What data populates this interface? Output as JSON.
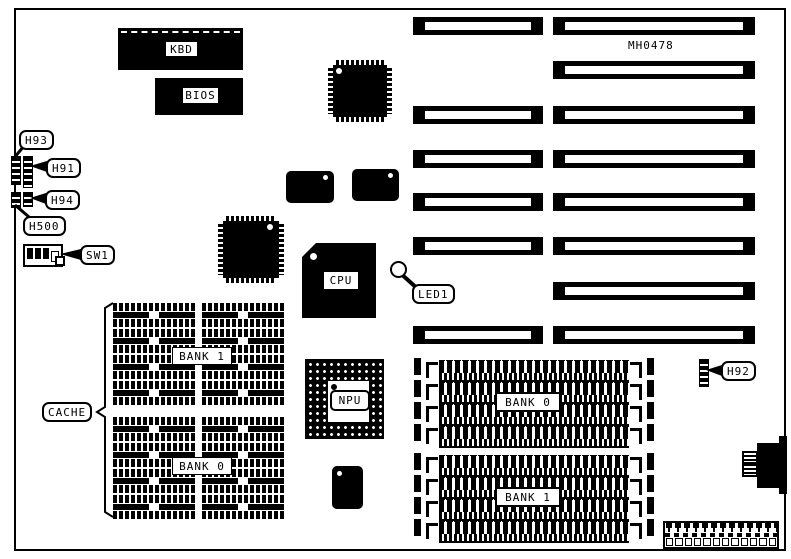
{
  "diagram": {
    "part_number": "MH0478"
  },
  "colors": {
    "ink": "#000000",
    "paper": "#ffffff"
  },
  "chips": {
    "kbd_label": "KBD",
    "bios_label": "BIOS",
    "cpu_label": "CPU",
    "npu_label": "NPU"
  },
  "callouts": {
    "h93": "H93",
    "h91": "H91",
    "h94": "H94",
    "h500": "H500",
    "sw1": "SW1",
    "led1": "LED1",
    "h92": "H92",
    "cache": "CACHE"
  },
  "memory": {
    "cache_bank1_label": "BANK 1",
    "cache_bank0_label": "BANK 0",
    "dram_bank0_label": "BANK 0",
    "dram_bank1_label": "BANK 1"
  }
}
